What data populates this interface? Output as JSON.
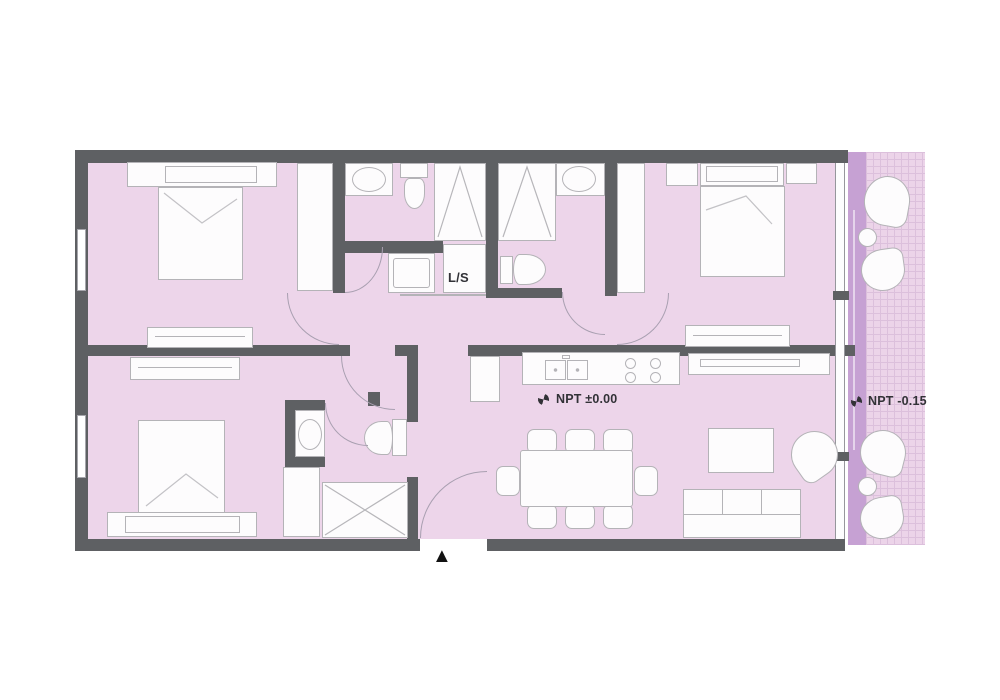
{
  "plan": {
    "labels": {
      "laundry": "L/S",
      "level_interior": "NPT ±0.00",
      "level_balcony": "NPT -0.15"
    },
    "icons": {
      "entrance_arrow": "▲",
      "level_benchmark": "quadrant-circle-benchmark"
    },
    "colors": {
      "floor": "#edd5ea",
      "balcony_tile": "#ecd4e9",
      "balcony_grid": "#dcc0dc",
      "window_strip": "#c6a1d3",
      "wall": "#5e6063",
      "furn_fill": "#fdfcfd",
      "furn_stroke": "#b4b3b7",
      "arc": "#a89fb0",
      "text": "#323237",
      "background": "#ffffff",
      "entrance_arrow": "#121212"
    }
  }
}
